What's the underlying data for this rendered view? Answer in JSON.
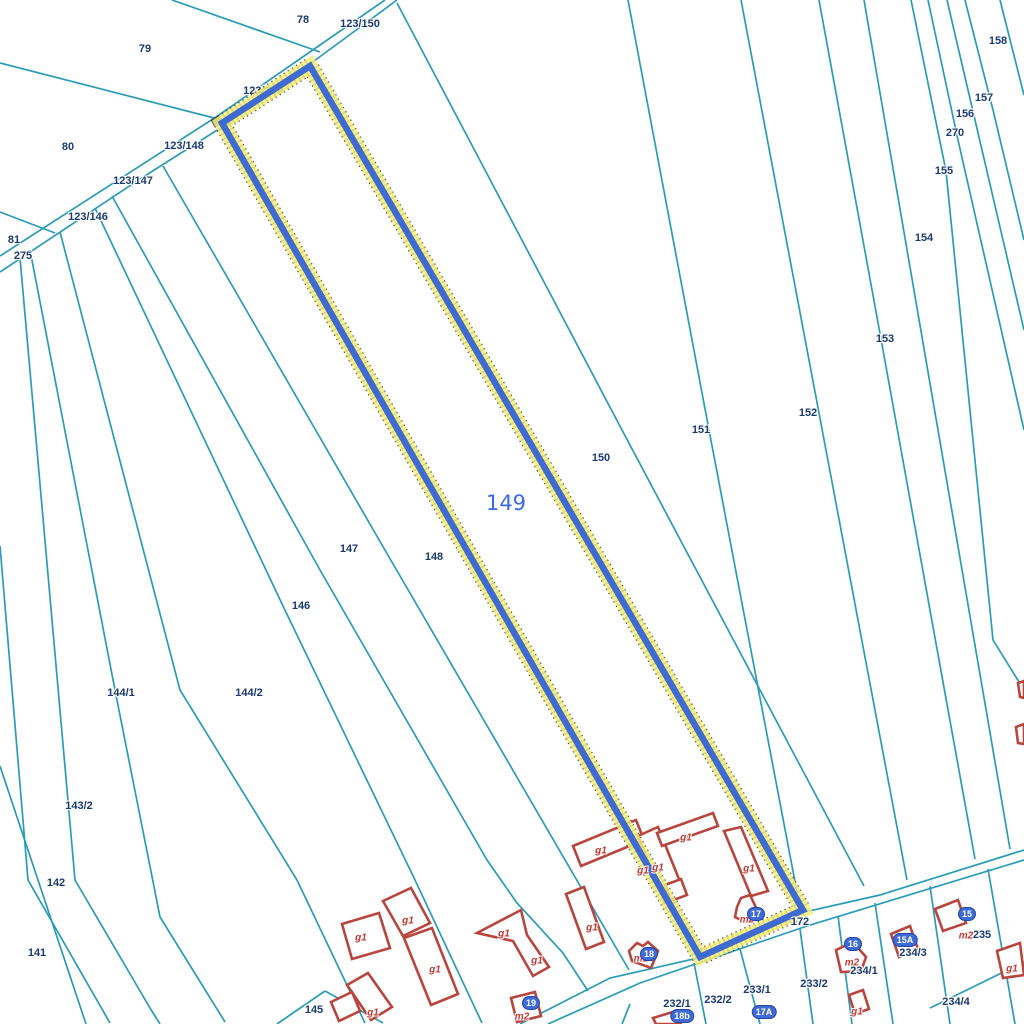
{
  "map": {
    "colors": {
      "background": "#ffffff",
      "parcel_line": "#2b9cb8",
      "building_outline": "#b8463e",
      "parcel_label": "#1c3a72",
      "building_label": "#c13a34",
      "selected_core": "#3f6ad2",
      "selected_halo": "#f5ef79",
      "selected_big_label": "#3a6ae8",
      "badge_background": "#3f6bd8"
    },
    "selected_parcel": {
      "number": "149",
      "label": {
        "x": 506,
        "y": 503
      },
      "outline": "222,123 310,66 803,910 700,957"
    },
    "boundary_lines": [
      {
        "points": "397,0 310,64 222,127 140,179 0,272"
      },
      {
        "points": "385,0 216,117 0,256"
      },
      {
        "points": "172,0 320,52"
      },
      {
        "points": "0,63 218,119"
      },
      {
        "points": "0,212 55,233"
      },
      {
        "points": "163,166 389,557 629,970"
      },
      {
        "points": "112,196 320,570 487,860 517,903 563,953 588,991"
      },
      {
        "points": "95,208 283,606 415,880 482,1023"
      },
      {
        "points": "60,232 180,690 297,880 365,1023"
      },
      {
        "points": "30,250 115,690 160,917 225,1022"
      },
      {
        "points": "20,258 75,880 150,1008 160,1024"
      },
      {
        "points": "0,546 28,880 110,1023"
      },
      {
        "points": "0,766 50,916 86,1024"
      },
      {
        "points": "397,3 622,430 864,886"
      },
      {
        "points": "628,0 709,430 800,908"
      },
      {
        "points": "741,0 819,413 907,880"
      },
      {
        "points": "819,0 881,339 975,859"
      },
      {
        "points": "864,0 905,238 1010,849"
      },
      {
        "points": "911,0 946,171 993,640 1024,690"
      },
      {
        "points": "928,0 958,140 1024,430"
      },
      {
        "points": "947,0 975,120 1024,330"
      },
      {
        "points": "965,0 993,110 1024,240"
      },
      {
        "points": "1000,0 1024,95"
      },
      {
        "points": "520,1024 610,978 698,958 800,913 880,895 1024,850"
      },
      {
        "points": "548,1024 640,983 810,925 1024,860"
      },
      {
        "points": "277,1024 325,991"
      },
      {
        "points": "325,991 383,1023"
      },
      {
        "points": "630,1004 622,1024"
      },
      {
        "points": "694,963 706,1024"
      },
      {
        "points": "740,949 760,1024"
      },
      {
        "points": "800,929 813,1024"
      },
      {
        "points": "838,916 852,1024"
      },
      {
        "points": "875,903 893,1024"
      },
      {
        "points": "930,886 950,1024"
      },
      {
        "points": "988,869 1015,1024"
      },
      {
        "points": "930,1008 1024,962"
      }
    ],
    "buildings": [
      {
        "points": "573,846 636,820 644,840 581,866"
      },
      {
        "points": "638,836 658,827 685,894 665,903"
      },
      {
        "points": "665,885 681,879 687,895 671,901"
      },
      {
        "points": "657,833 713,813 718,826 662,846"
      },
      {
        "points": "724,831 741,827 768,891 751,896"
      },
      {
        "points": "737,907 741,898 750,895 759,914 745,922 735,917"
      },
      {
        "points": "629,951 637,943 643,946 648,942 658,951 651,968 632,961"
      },
      {
        "points": "342,924 379,913 390,948 352,959"
      },
      {
        "points": "383,901 411,888 430,923 403,936"
      },
      {
        "points": "404,938 432,928 458,994 431,1005"
      },
      {
        "points": "347,985 368,973 392,1007 371,1020"
      },
      {
        "points": "331,1002 352,992 360,1011 339,1021"
      },
      {
        "points": "477,933 521,910 527,935 549,967 533,976 513,941"
      },
      {
        "points": "511,998 535,992 541,1016 517,1022"
      },
      {
        "points": "566,894 584,887 604,942 586,949"
      },
      {
        "points": "836,950 853,942 866,957 861,971 841,972"
      },
      {
        "points": "891,934 910,926 918,949 899,957"
      },
      {
        "points": "935,909 958,900 966,923 943,931"
      },
      {
        "points": "849,995 863,990 869,1009 855,1014"
      },
      {
        "points": "997,951 1020,943 1024,975 1003,978"
      },
      {
        "points": "1018,683 1024,681 1024,698 1020,697"
      },
      {
        "points": "1016,727 1024,724 1024,744 1018,743"
      },
      {
        "points": "653,1018 676,1011 681,1024 656,1024"
      }
    ],
    "hidden_parcel_labels": [
      {
        "text": "123/149",
        "x": 263,
        "y": 90
      }
    ],
    "parcel_labels": [
      {
        "text": "78",
        "x": 303,
        "y": 20
      },
      {
        "text": "123/150",
        "x": 360,
        "y": 24
      },
      {
        "text": "79",
        "x": 145,
        "y": 49
      },
      {
        "text": "80",
        "x": 68,
        "y": 147
      },
      {
        "text": "123/148",
        "x": 184,
        "y": 146
      },
      {
        "text": "123/147",
        "x": 133,
        "y": 181
      },
      {
        "text": "123/146",
        "x": 88,
        "y": 217
      },
      {
        "text": "81",
        "x": 14,
        "y": 240
      },
      {
        "text": "275",
        "x": 23,
        "y": 256
      },
      {
        "text": "158",
        "x": 998,
        "y": 41
      },
      {
        "text": "157",
        "x": 984,
        "y": 98
      },
      {
        "text": "156",
        "x": 965,
        "y": 114
      },
      {
        "text": "270",
        "x": 955,
        "y": 133
      },
      {
        "text": "155",
        "x": 944,
        "y": 171
      },
      {
        "text": "154",
        "x": 924,
        "y": 238
      },
      {
        "text": "153",
        "x": 885,
        "y": 339
      },
      {
        "text": "152",
        "x": 808,
        "y": 413
      },
      {
        "text": "151",
        "x": 701,
        "y": 430
      },
      {
        "text": "150",
        "x": 601,
        "y": 458
      },
      {
        "text": "147",
        "x": 349,
        "y": 549
      },
      {
        "text": "148",
        "x": 434,
        "y": 557
      },
      {
        "text": "146",
        "x": 301,
        "y": 606
      },
      {
        "text": "144/1",
        "x": 121,
        "y": 693
      },
      {
        "text": "144/2",
        "x": 249,
        "y": 693
      },
      {
        "text": "143/2",
        "x": 79,
        "y": 806
      },
      {
        "text": "142",
        "x": 56,
        "y": 883
      },
      {
        "text": "141",
        "x": 37,
        "y": 953
      },
      {
        "text": "145",
        "x": 314,
        "y": 1010
      },
      {
        "text": "172",
        "x": 800,
        "y": 922
      },
      {
        "text": "232/1",
        "x": 677,
        "y": 1004
      },
      {
        "text": "232/2",
        "x": 718,
        "y": 1000
      },
      {
        "text": "233/1",
        "x": 757,
        "y": 990
      },
      {
        "text": "233/2",
        "x": 814,
        "y": 984
      },
      {
        "text": "234/1",
        "x": 864,
        "y": 971
      },
      {
        "text": "234/3",
        "x": 913,
        "y": 953
      },
      {
        "text": "235",
        "x": 982,
        "y": 935
      },
      {
        "text": "234/4",
        "x": 956,
        "y": 1002
      }
    ],
    "building_labels": [
      {
        "text": "g1",
        "x": 601,
        "y": 851
      },
      {
        "text": "g1",
        "x": 643,
        "y": 871
      },
      {
        "text": "g1",
        "x": 658,
        "y": 868
      },
      {
        "text": "g1",
        "x": 686,
        "y": 838
      },
      {
        "text": "g1",
        "x": 749,
        "y": 869
      },
      {
        "text": "g1",
        "x": 592,
        "y": 928
      },
      {
        "text": "g1",
        "x": 361,
        "y": 938
      },
      {
        "text": "g1",
        "x": 408,
        "y": 921
      },
      {
        "text": "g1",
        "x": 435,
        "y": 970
      },
      {
        "text": "g1",
        "x": 373,
        "y": 1013
      },
      {
        "text": "g1",
        "x": 504,
        "y": 934
      },
      {
        "text": "g1",
        "x": 537,
        "y": 961
      },
      {
        "text": "g1",
        "x": 857,
        "y": 1012
      },
      {
        "text": "g1",
        "x": 1012,
        "y": 969
      },
      {
        "text": "m1",
        "x": 641,
        "y": 959
      },
      {
        "text": "m2",
        "x": 747,
        "y": 920
      },
      {
        "text": "m2",
        "x": 522,
        "y": 1017
      },
      {
        "text": "m2",
        "x": 852,
        "y": 963
      },
      {
        "text": "m2",
        "x": 966,
        "y": 936
      }
    ],
    "address_badges": [
      {
        "text": "17",
        "x": 756,
        "y": 914
      },
      {
        "text": "18",
        "x": 649,
        "y": 954
      },
      {
        "text": "19",
        "x": 531,
        "y": 1003
      },
      {
        "text": "18b",
        "x": 682,
        "y": 1016
      },
      {
        "text": "17A",
        "x": 764,
        "y": 1012
      },
      {
        "text": "16",
        "x": 853,
        "y": 944
      },
      {
        "text": "15A",
        "x": 905,
        "y": 940
      },
      {
        "text": "15",
        "x": 967,
        "y": 914
      }
    ]
  }
}
